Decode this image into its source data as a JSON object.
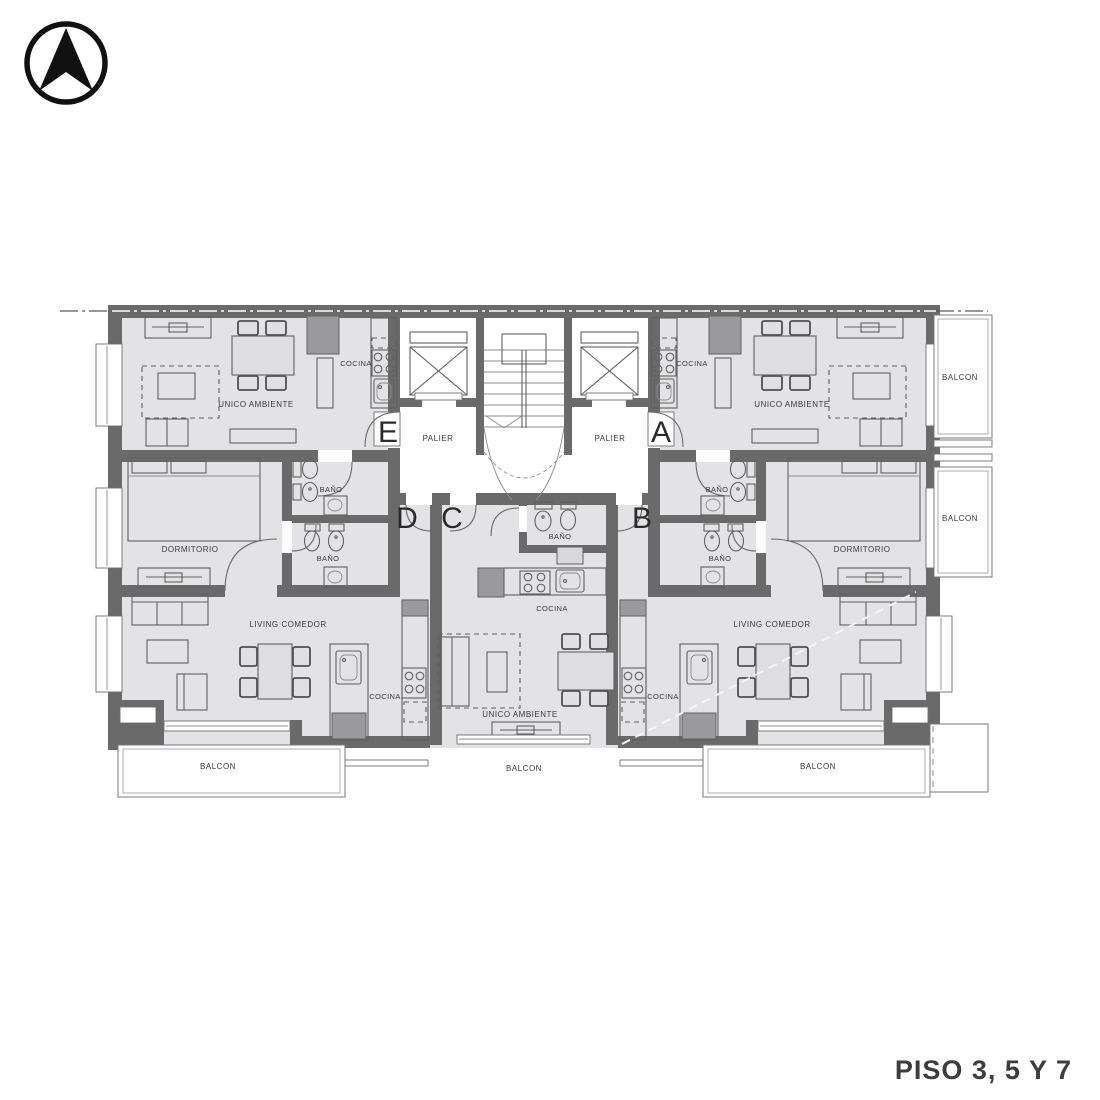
{
  "document": {
    "type": "apartment-floor-plan",
    "floor_title": "PISO 3, 5 Y 7"
  },
  "north_arrow": {
    "icon": "north-arrow-icon"
  },
  "colors": {
    "wall": "#6a6a6a",
    "floor": "#e3e3e5",
    "text": "#3a3a3a",
    "white": "#ffffff"
  },
  "core": {
    "palier_left": "PALIER",
    "palier_right": "PALIER",
    "elevators": 2,
    "stairs": true
  },
  "apartments": [
    {
      "letter": "E",
      "rooms": [
        "UNICO AMBIENTE",
        "COCINA",
        "BAÑO"
      ]
    },
    {
      "letter": "A",
      "rooms": [
        "UNICO AMBIENTE",
        "COCINA",
        "BAÑO",
        "BALCON"
      ]
    },
    {
      "letter": "D",
      "rooms": [
        "DORMITORIO",
        "BAÑO",
        "LIVING COMEDOR",
        "COCINA",
        "BALCON"
      ]
    },
    {
      "letter": "C",
      "rooms": [
        "BAÑO",
        "COCINA",
        "UNICO AMBIENTE",
        "BALCON"
      ]
    },
    {
      "letter": "B",
      "rooms": [
        "DORMITORIO",
        "BAÑO",
        "LIVING COMEDOR",
        "COCINA",
        "BALCON"
      ]
    }
  ],
  "letters": [
    {
      "ch": "E"
    },
    {
      "ch": "A"
    },
    {
      "ch": "D"
    },
    {
      "ch": "C"
    },
    {
      "ch": "B"
    }
  ],
  "labels": [
    {
      "id": "unico-ambiente-e",
      "text": "UNICO AMBIENTE"
    },
    {
      "id": "cocina-e",
      "text": "COCINA"
    },
    {
      "id": "palier-left",
      "text": "PALIER"
    },
    {
      "id": "palier-right",
      "text": "PALIER"
    },
    {
      "id": "cocina-a",
      "text": "COCINA"
    },
    {
      "id": "unico-ambiente-a",
      "text": "UNICO AMBIENTE"
    },
    {
      "id": "balcon-right-top",
      "text": "BALCON"
    },
    {
      "id": "bano-e",
      "text": "BAÑO"
    },
    {
      "id": "bano-a",
      "text": "BAÑO"
    },
    {
      "id": "dormitorio-d",
      "text": "DORMITORIO"
    },
    {
      "id": "dormitorio-b",
      "text": "DORMITORIO"
    },
    {
      "id": "balcon-right-mid",
      "text": "BALCON"
    },
    {
      "id": "bano-d",
      "text": "BAÑO"
    },
    {
      "id": "bano-b",
      "text": "BAÑO"
    },
    {
      "id": "bano-c",
      "text": "BAÑO"
    },
    {
      "id": "cocina-c",
      "text": "COCINA"
    },
    {
      "id": "living-comedor-d",
      "text": "LIVING COMEDOR"
    },
    {
      "id": "living-comedor-b",
      "text": "LIVING COMEDOR"
    },
    {
      "id": "cocina-d",
      "text": "COCINA"
    },
    {
      "id": "cocina-b",
      "text": "COCINA"
    },
    {
      "id": "unico-ambiente-c",
      "text": "UNICO AMBIENTE"
    },
    {
      "id": "balcon-bottom-left",
      "text": "BALCON"
    },
    {
      "id": "balcon-bottom-center",
      "text": "BALCON"
    },
    {
      "id": "balcon-bottom-right",
      "text": "BALCON"
    }
  ],
  "title": "PISO 3, 5 Y 7"
}
